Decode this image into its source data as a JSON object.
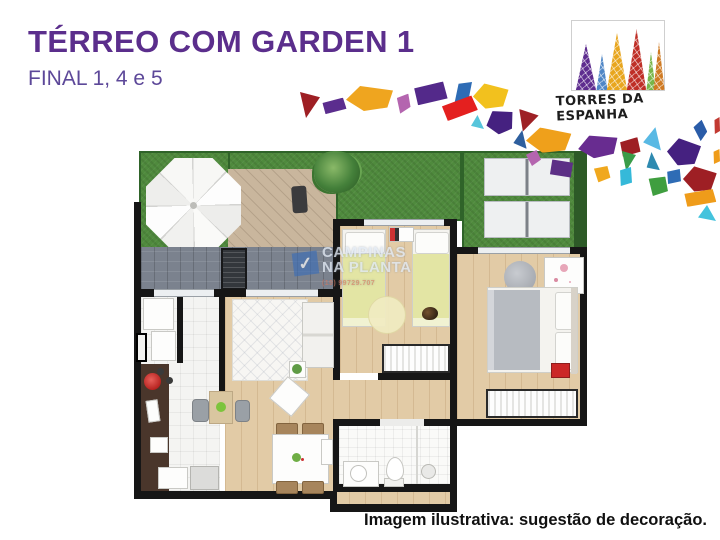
{
  "header": {
    "title": "TÉRREO COM GARDEN 1",
    "subtitle": "FINAL 1, 4 e 5"
  },
  "logo": {
    "name": "TORRES DA ESPANHA",
    "towers": [
      {
        "x": 3,
        "w": 22,
        "h": 46,
        "color": "#5e2d8f"
      },
      {
        "x": 24,
        "w": 12,
        "h": 36,
        "color": "#4f86c6"
      },
      {
        "x": 34,
        "w": 22,
        "h": 57,
        "color": "#e8a61e"
      },
      {
        "x": 54,
        "w": 21,
        "h": 61,
        "color": "#bf2f27"
      },
      {
        "x": 74,
        "w": 10,
        "h": 38,
        "color": "#78b549"
      },
      {
        "x": 81,
        "w": 12,
        "h": 48,
        "color": "#cf7a22"
      }
    ]
  },
  "caption": "Imagem ilustrativa: sugestão de decoração.",
  "watermark": {
    "line1": "CAMPINAS",
    "line2": "NA PLANTA",
    "phone": "(19) 99729.707",
    "check_glyph": "✓"
  },
  "palette": {
    "grass": "#4f8a3d",
    "grassDark": "#2f6329",
    "deck": "#c9b69d",
    "deckLine": "#b5a28a",
    "patio": "#7b828e",
    "wood": "#e2cba6",
    "tile": "#f4f4f2",
    "wall": "#161616",
    "counter": "#4a362b",
    "hedge": "#2d5a27",
    "bedYellow": "#e3e5a4",
    "blanketGray": "#b7bbc1",
    "red": "#cb2727",
    "wmBlue": "#3f6fb5",
    "accentTitle": "#5b2e8c",
    "accentSub": "#5d4899"
  },
  "mosaic_pieces": [
    {
      "x": 300,
      "y": 92,
      "w": 20,
      "h": 26,
      "color": "#9e1f24",
      "rot": 0,
      "shape": "tri2"
    },
    {
      "x": 321,
      "y": 99,
      "w": 25,
      "h": 14,
      "color": "#5b2d8e",
      "rot": -8,
      "shape": "quad"
    },
    {
      "x": 346,
      "y": 86,
      "w": 47,
      "h": 25,
      "color": "#efa51f",
      "rot": 0,
      "shape": "pent"
    },
    {
      "x": 396,
      "y": 93,
      "w": 15,
      "h": 21,
      "color": "#b465af",
      "rot": 10,
      "shape": "quad2"
    },
    {
      "x": 412,
      "y": 83,
      "w": 35,
      "h": 21,
      "color": "#53298a",
      "rot": -6,
      "shape": "quad"
    },
    {
      "x": 455,
      "y": 80,
      "w": 15,
      "h": 28,
      "color": "#2e6cb5",
      "rot": 14,
      "shape": "quad"
    },
    {
      "x": 440,
      "y": 99,
      "w": 37,
      "h": 19,
      "color": "#e4201f",
      "rot": -14,
      "shape": "quad"
    },
    {
      "x": 473,
      "y": 84,
      "w": 35,
      "h": 25,
      "color": "#f2c11e",
      "rot": 4,
      "shape": "pent"
    },
    {
      "x": 471,
      "y": 115,
      "w": 13,
      "h": 14,
      "color": "#57c5db",
      "rot": 0,
      "shape": "tri"
    },
    {
      "x": 486,
      "y": 110,
      "w": 28,
      "h": 24,
      "color": "#452180",
      "rot": -10,
      "shape": "pent"
    },
    {
      "x": 518,
      "y": 110,
      "w": 20,
      "h": 22,
      "color": "#9e2125",
      "rot": 6,
      "shape": "tri2"
    },
    {
      "x": 514,
      "y": 130,
      "w": 14,
      "h": 18,
      "color": "#2e5f9e",
      "rot": 8,
      "shape": "tri"
    },
    {
      "x": 526,
      "y": 128,
      "w": 45,
      "h": 25,
      "color": "#efa01b",
      "rot": 3,
      "shape": "pent"
    },
    {
      "x": 526,
      "y": 150,
      "w": 15,
      "h": 16,
      "color": "#b465af",
      "rot": 0,
      "shape": "quad2"
    },
    {
      "x": 578,
      "y": 135,
      "w": 40,
      "h": 23,
      "color": "#682c90",
      "rot": -4,
      "shape": "pent"
    },
    {
      "x": 619,
      "y": 138,
      "w": 21,
      "h": 18,
      "color": "#9e1f24",
      "rot": -6,
      "shape": "quad"
    },
    {
      "x": 644,
      "y": 127,
      "w": 19,
      "h": 22,
      "color": "#59b9e4",
      "rot": 10,
      "shape": "tri"
    },
    {
      "x": 694,
      "y": 120,
      "w": 13,
      "h": 21,
      "color": "#2a5ca8",
      "rot": -8,
      "shape": "quad2"
    },
    {
      "x": 667,
      "y": 139,
      "w": 33,
      "h": 27,
      "color": "#452180",
      "rot": 8,
      "shape": "pent"
    },
    {
      "x": 622,
      "y": 151,
      "w": 14,
      "h": 20,
      "color": "#3a9c48",
      "rot": 0,
      "shape": "tri2"
    },
    {
      "x": 593,
      "y": 165,
      "w": 18,
      "h": 18,
      "color": "#f0a81e",
      "rot": 12,
      "shape": "quad2"
    },
    {
      "x": 619,
      "y": 167,
      "w": 13,
      "h": 19,
      "color": "#35b9d9",
      "rot": 0,
      "shape": "quad"
    },
    {
      "x": 646,
      "y": 152,
      "w": 13,
      "h": 19,
      "color": "#2e8ab0",
      "rot": -6,
      "shape": "tri"
    },
    {
      "x": 647,
      "y": 175,
      "w": 22,
      "h": 22,
      "color": "#3f9e3f",
      "rot": 16,
      "shape": "quad2"
    },
    {
      "x": 666,
      "y": 169,
      "w": 15,
      "h": 15,
      "color": "#2e6cb5",
      "rot": 0,
      "shape": "quad"
    },
    {
      "x": 683,
      "y": 167,
      "w": 33,
      "h": 25,
      "color": "#9e1f24",
      "rot": 6,
      "shape": "pent"
    },
    {
      "x": 682,
      "y": 190,
      "w": 34,
      "h": 16,
      "color": "#ef9c1a",
      "rot": -4,
      "shape": "quad"
    },
    {
      "x": 698,
      "y": 205,
      "w": 18,
      "h": 16,
      "color": "#44c3dd",
      "rot": 0,
      "shape": "tri"
    },
    {
      "x": 713,
      "y": 149,
      "w": 7,
      "h": 15,
      "color": "#ef9c1a",
      "rot": 0,
      "shape": "quad"
    },
    {
      "x": 714,
      "y": 117,
      "w": 6,
      "h": 17,
      "color": "#c23a32",
      "rot": 0,
      "shape": "quad"
    }
  ]
}
